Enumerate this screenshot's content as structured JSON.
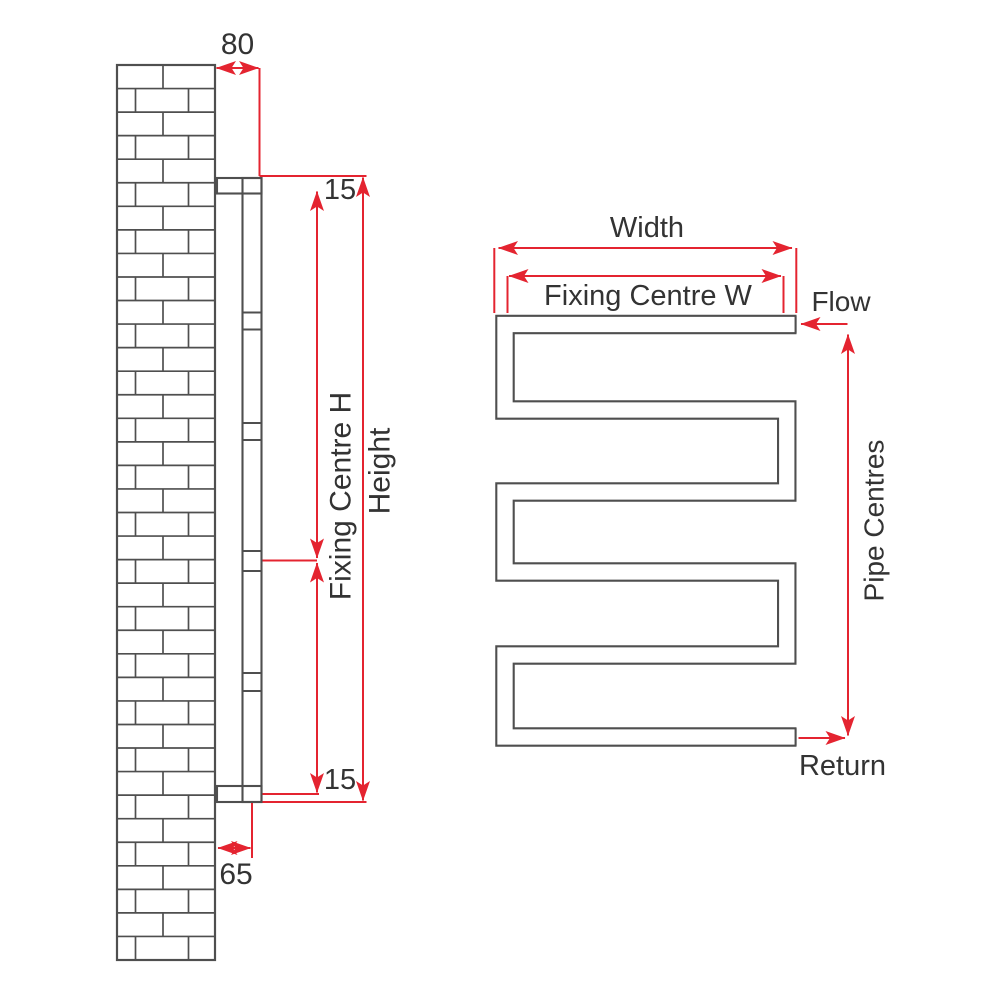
{
  "diagram": {
    "type": "technical-dimension-drawing",
    "subject": "wall-mounted serpentine towel radiator, side view and front view",
    "colors": {
      "outline": "#4f4f4f",
      "dimension": "#e42430",
      "label": "#333333",
      "background": "#ffffff"
    }
  },
  "side_view": {
    "labels": {
      "wall_to_face_depth": "80",
      "top_offset": "15",
      "fixing_centre_h": "Fixing Centre H",
      "height": "Height",
      "bottom_offset": "15",
      "wall_to_pipe_centre": "65"
    }
  },
  "front_view": {
    "labels": {
      "width": "Width",
      "fixing_centre_w": "Fixing Centre W",
      "flow": "Flow",
      "pipe_centres": "Pipe Centres",
      "return": "Return"
    }
  }
}
